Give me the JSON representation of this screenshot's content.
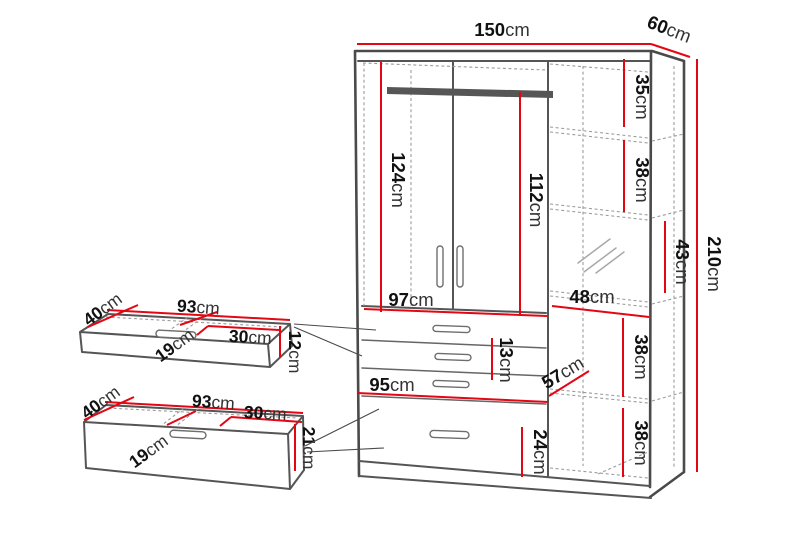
{
  "diagram": "wardrobe-dimension-drawing",
  "unit": "cm",
  "colors": {
    "dimension_red": "#e30613",
    "outline_gray": "#4a4a4a",
    "hidden_edge_gray": "#9b9b9b",
    "text_black": "#141414",
    "background": "#ffffff"
  },
  "wardrobe": {
    "width": {
      "v": "150",
      "u": "cm"
    },
    "depth": {
      "v": "60",
      "u": "cm"
    },
    "height": {
      "v": "210",
      "u": "cm"
    },
    "left_door_interior_height": {
      "v": "124",
      "u": "cm"
    },
    "right_door_interior_height": {
      "v": "112",
      "u": "cm"
    },
    "door_section_width": {
      "v": "97",
      "u": "cm"
    },
    "shelf_top_height": {
      "v": "35",
      "u": "cm"
    },
    "shelf_second_height": {
      "v": "38",
      "u": "cm"
    },
    "mirror_shelf_height": {
      "v": "43",
      "u": "cm"
    },
    "shelf_section_width": {
      "v": "48",
      "u": "cm"
    },
    "shelf_fourth_height": {
      "v": "38",
      "u": "cm"
    },
    "shelf_fifth_height": {
      "v": "38",
      "u": "cm"
    },
    "shelf_depth": {
      "v": "57",
      "u": "cm"
    },
    "small_drawer_front_height": {
      "v": "13",
      "u": "cm"
    },
    "drawer_section_width": {
      "v": "95",
      "u": "cm"
    },
    "large_drawer_front_height": {
      "v": "24",
      "u": "cm"
    }
  },
  "small_drawer": {
    "depth": {
      "v": "40",
      "u": "cm"
    },
    "width": {
      "v": "93",
      "u": "cm"
    },
    "inner_depth": {
      "v": "19",
      "u": "cm"
    },
    "inner_width": {
      "v": "30",
      "u": "cm"
    },
    "height": {
      "v": "12",
      "u": "cm"
    }
  },
  "large_drawer": {
    "depth": {
      "v": "40",
      "u": "cm"
    },
    "width": {
      "v": "93",
      "u": "cm"
    },
    "inner_depth": {
      "v": "19",
      "u": "cm"
    },
    "inner_width": {
      "v": "30",
      "u": "cm"
    },
    "height": {
      "v": "21",
      "u": "cm"
    }
  }
}
